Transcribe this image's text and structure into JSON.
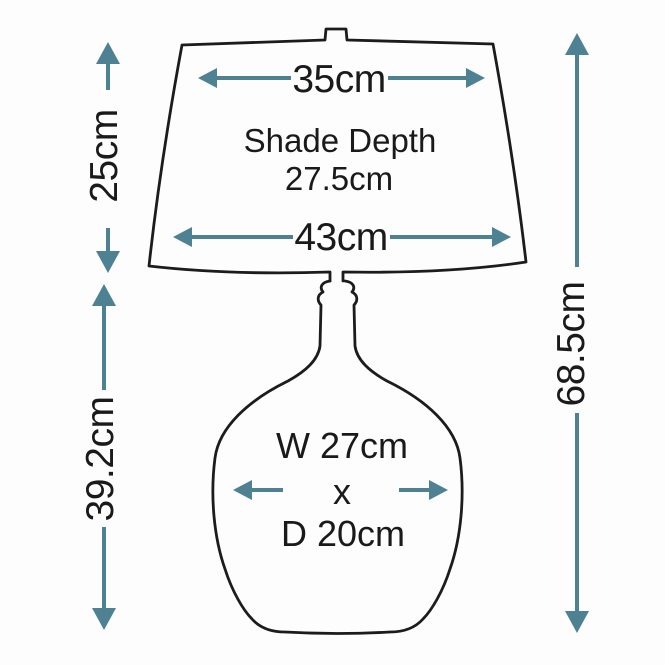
{
  "diagram": {
    "type": "lamp-dimension-diagram",
    "shade": {
      "top_width": "35cm",
      "depth_label": "Shade Depth",
      "depth_value": "27.5cm",
      "bottom_width": "43cm",
      "height": "25cm"
    },
    "base": {
      "height": "39.2cm",
      "width": "W 27cm",
      "separator": "x",
      "depth": "D 20cm"
    },
    "overall": {
      "total_height": "68.5cm"
    },
    "colors": {
      "arrow": "#4e8292",
      "outline": "#1c1c1c",
      "text": "#1a1a1a",
      "background": "#fdfdfd"
    }
  }
}
